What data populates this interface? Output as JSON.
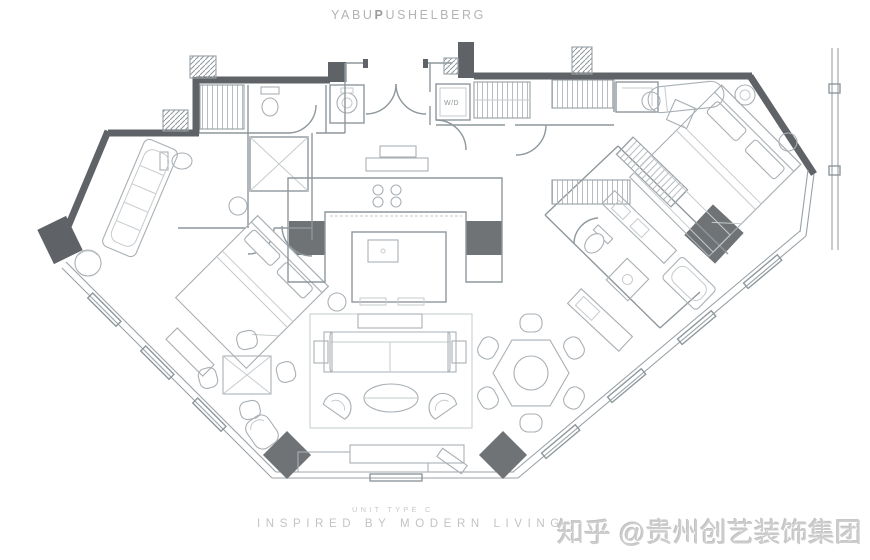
{
  "branding": {
    "logo_pre": "YABU",
    "logo_bold": "P",
    "logo_post": "USHELBERG"
  },
  "plan": {
    "washer_dryer_label": "W/D"
  },
  "footer": {
    "unit_label": "UNIT TYPE C",
    "tagline": "INSPIRED BY MODERN LIVING"
  },
  "watermark": {
    "text": "知乎 @贵州创艺装饰集团"
  },
  "colors": {
    "wall": "#5f6367",
    "column": "#6f7376",
    "partition": "#8e979c",
    "furniture": "#a9b0b5",
    "logo_text": "#b4b4b4",
    "footer_text": "#c3c3c3",
    "watermark_text": "#cdcdcd",
    "background": "#ffffff"
  }
}
